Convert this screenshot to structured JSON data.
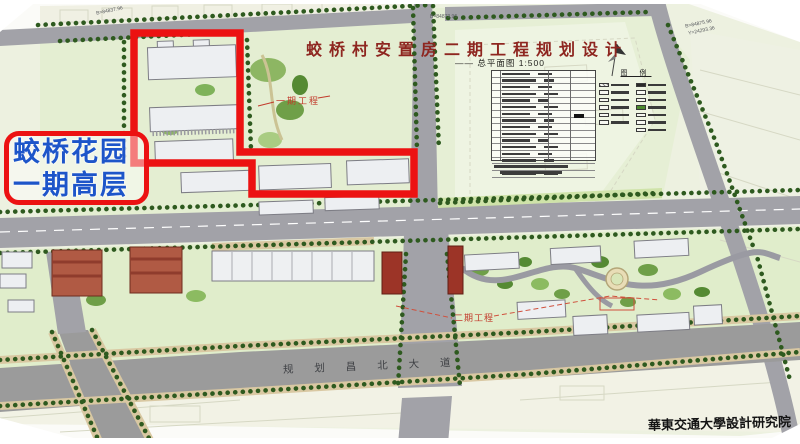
{
  "title": {
    "main": "蛟桥村安置房二期工程规划设计",
    "sub": "——  总平面图  1:500"
  },
  "callout": {
    "line1": "蛟桥花园",
    "line2": "一期高层",
    "border_color": "#ec1212",
    "text_color": "#1d55c9"
  },
  "map_labels": {
    "phase1": "一期工程",
    "phase2": "二期工程",
    "road_name": "规 划 昌 北 大 道",
    "signature": "華東交通大學設計研究院"
  },
  "survey_markers": {
    "m1": "B=84837.96",
    "m2": "B=84872.96",
    "m3": "B=84875.96",
    "m4": "Y=24293.36"
  },
  "legend": {
    "title": "图 例",
    "swatches_left": [
      "hatched",
      "outline",
      "outline",
      "outline",
      "outline",
      "outline"
    ],
    "swatches_right": [
      "dark",
      "outline",
      "outline",
      "green",
      "outline",
      "outline",
      "outline"
    ]
  },
  "indicator_table": {
    "rows": 16,
    "note_lines": 2,
    "legible": false
  },
  "colors": {
    "highlight_red": "#ec1212",
    "title_red": "#8e2620",
    "phase_label_red": "#c23a2b",
    "road_gray": "#a2a2a8",
    "tree_green": "#2e5a1f",
    "lawn_green": "#e6efd5"
  }
}
